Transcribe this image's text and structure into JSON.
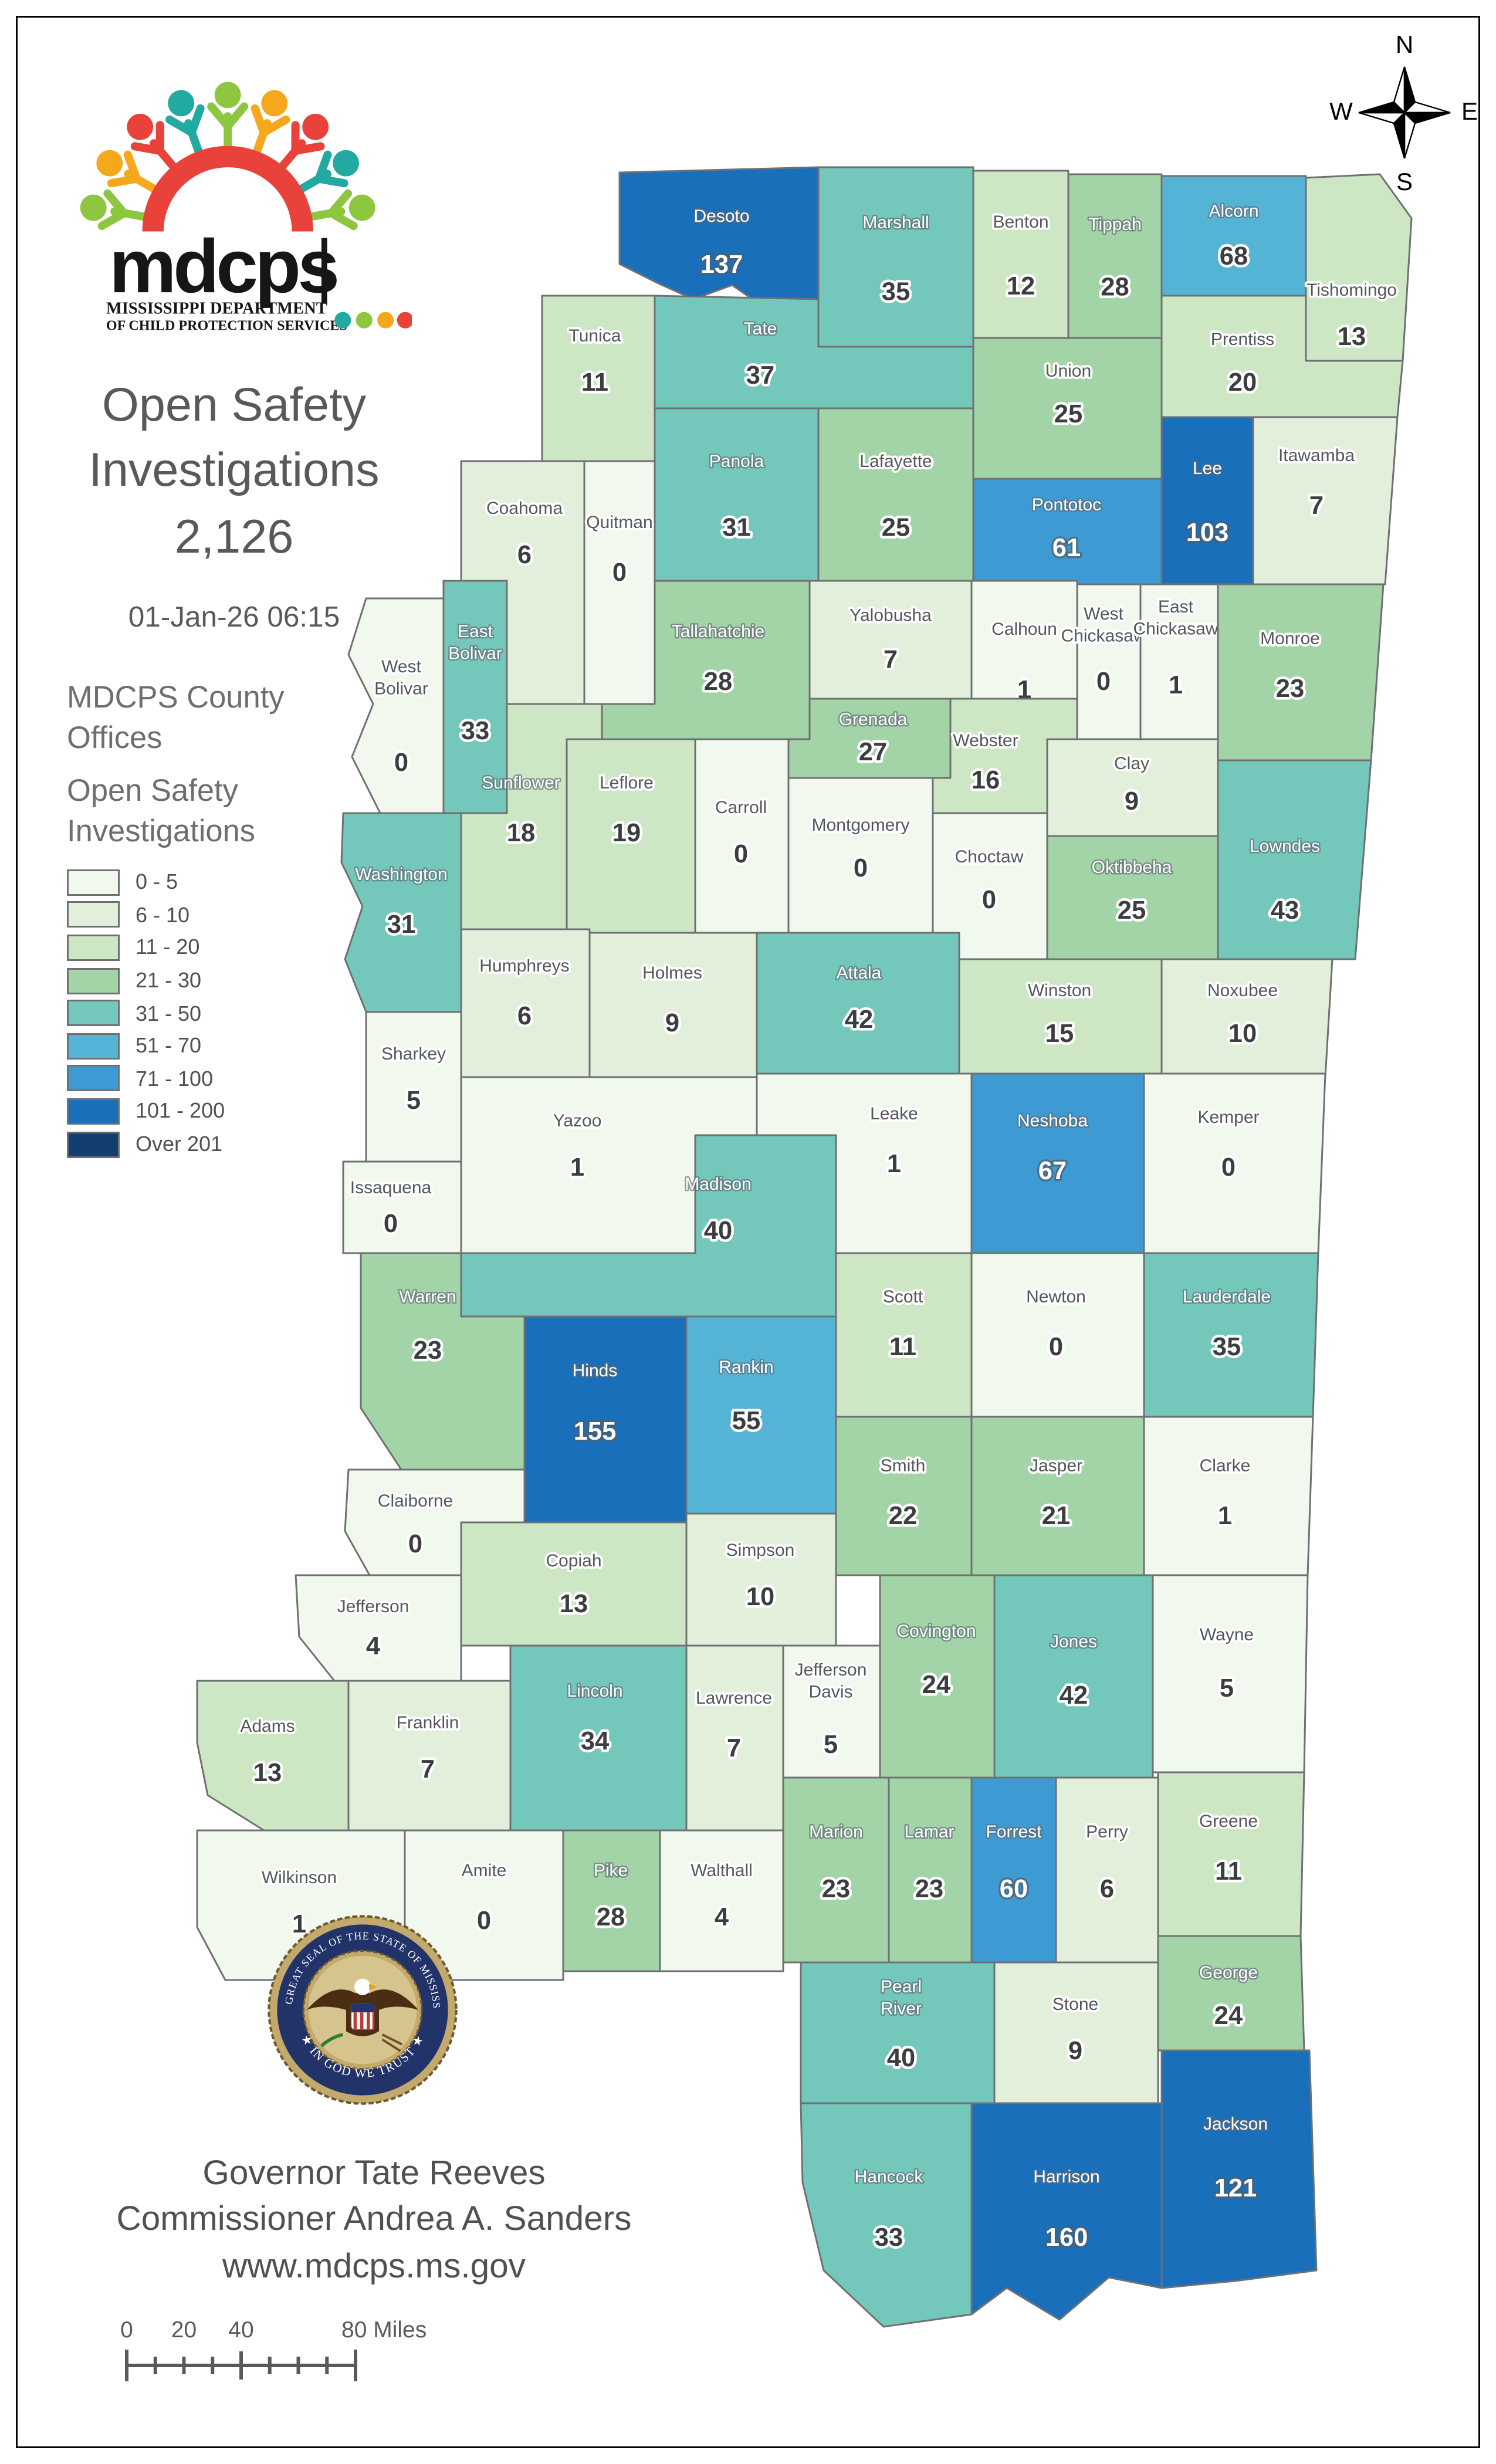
{
  "header": {
    "logo": {
      "acronym": "mdcps",
      "dept_line1": "MISSISSIPPI DEPARTMENT",
      "dept_line2": "OF CHILD PROTECTION SERVICES"
    },
    "title_lines": [
      "Open Safety",
      "Investigations",
      "2,126"
    ],
    "timestamp": "01-Jan-26 06:15"
  },
  "legend": {
    "offices_title_lines": [
      "MDCPS County",
      "Offices"
    ],
    "title_lines": [
      "Open Safety",
      "Investigations"
    ],
    "classes": [
      {
        "label": "0 - 5",
        "color": "#f1f8ed"
      },
      {
        "label": "6 - 10",
        "color": "#e2f0db"
      },
      {
        "label": "11 - 20",
        "color": "#cde7c5"
      },
      {
        "label": "21 - 30",
        "color": "#a3d4a7"
      },
      {
        "label": "31 - 50",
        "color": "#74c7bb"
      },
      {
        "label": "51 - 70",
        "color": "#55b4d5"
      },
      {
        "label": "71 - 100",
        "color": "#3e9ad2"
      },
      {
        "label": "101 - 200",
        "color": "#1a6fba"
      },
      {
        "label": "Over 201",
        "color": "#133f70"
      }
    ]
  },
  "compass": {
    "n": "N",
    "e": "E",
    "s": "S",
    "w": "W"
  },
  "map": {
    "counties": [
      {
        "name_lines": [
          "Desoto"
        ],
        "value": 137,
        "bucket": 8,
        "name_style": "light",
        "value_style": "light"
      },
      {
        "name_lines": [
          "Marshall"
        ],
        "value": 35,
        "bucket": 5,
        "name_style": "light",
        "value_style": "dark"
      },
      {
        "name_lines": [
          "Benton"
        ],
        "value": 12,
        "bucket": 3,
        "name_style": "dark",
        "value_style": "dark"
      },
      {
        "name_lines": [
          "Tippah"
        ],
        "value": 28,
        "bucket": 4,
        "name_style": "light",
        "value_style": "dark"
      },
      {
        "name_lines": [
          "Alcorn"
        ],
        "value": 68,
        "bucket": 6,
        "name_style": "light",
        "value_style": "dark"
      },
      {
        "name_lines": [
          "Tishomingo"
        ],
        "value": 13,
        "bucket": 3,
        "name_style": "dark",
        "value_style": "dark"
      },
      {
        "name_lines": [
          "Tunica"
        ],
        "value": 11,
        "bucket": 3,
        "name_style": "dark",
        "value_style": "dark"
      },
      {
        "name_lines": [
          "Tate"
        ],
        "value": 37,
        "bucket": 5,
        "name_style": "light",
        "value_style": "dark"
      },
      {
        "name_lines": [
          "Prentiss"
        ],
        "value": 20,
        "bucket": 3,
        "name_style": "dark",
        "value_style": "dark"
      },
      {
        "name_lines": [
          "Union"
        ],
        "value": 25,
        "bucket": 4,
        "name_style": "dark",
        "value_style": "dark"
      },
      {
        "name_lines": [
          "Lee"
        ],
        "value": 103,
        "bucket": 8,
        "name_style": "light",
        "value_style": "light"
      },
      {
        "name_lines": [
          "Itawamba"
        ],
        "value": 7,
        "bucket": 2,
        "name_style": "dark",
        "value_style": "dark"
      },
      {
        "name_lines": [
          "Pontotoc"
        ],
        "value": 61,
        "bucket": 7,
        "name_style": "light",
        "value_style": "light"
      },
      {
        "name_lines": [
          "Lafayette"
        ],
        "value": 25,
        "bucket": 4,
        "name_style": "dark",
        "value_style": "dark"
      },
      {
        "name_lines": [
          "Panola"
        ],
        "value": 31,
        "bucket": 5,
        "name_style": "light",
        "value_style": "dark"
      },
      {
        "name_lines": [
          "Coahoma"
        ],
        "value": 6,
        "bucket": 2,
        "name_style": "dark",
        "value_style": "dark"
      },
      {
        "name_lines": [
          "Quitman"
        ],
        "value": 0,
        "bucket": 1,
        "name_style": "dark",
        "value_style": "dark"
      },
      {
        "name_lines": [
          "Tallahatchie"
        ],
        "value": 28,
        "bucket": 4,
        "name_style": "light",
        "value_style": "dark"
      },
      {
        "name_lines": [
          "Yalobusha"
        ],
        "value": 7,
        "bucket": 2,
        "name_style": "dark",
        "value_style": "dark"
      },
      {
        "name_lines": [
          "Calhoun"
        ],
        "value": 1,
        "bucket": 1,
        "name_style": "dark",
        "value_style": "dark"
      },
      {
        "name_lines": [
          "West",
          "Chickasaw"
        ],
        "value": 0,
        "bucket": 1,
        "name_style": "dark",
        "value_style": "dark"
      },
      {
        "name_lines": [
          "East",
          "Chickasaw"
        ],
        "value": 1,
        "bucket": 1,
        "name_style": "dark",
        "value_style": "dark"
      },
      {
        "name_lines": [
          "Monroe"
        ],
        "value": 23,
        "bucket": 4,
        "name_style": "dark",
        "value_style": "dark"
      },
      {
        "name_lines": [
          "East",
          "Bolivar"
        ],
        "value": 33,
        "bucket": 5,
        "name_style": "light",
        "value_style": "dark"
      },
      {
        "name_lines": [
          "West",
          "Bolivar"
        ],
        "value": 0,
        "bucket": 1,
        "name_style": "dark",
        "value_style": "dark"
      },
      {
        "name_lines": [
          "Grenada"
        ],
        "value": 27,
        "bucket": 4,
        "name_style": "light",
        "value_style": "dark"
      },
      {
        "name_lines": [
          "Webster"
        ],
        "value": 16,
        "bucket": 3,
        "name_style": "dark",
        "value_style": "dark"
      },
      {
        "name_lines": [
          "Clay"
        ],
        "value": 9,
        "bucket": 2,
        "name_style": "dark",
        "value_style": "dark"
      },
      {
        "name_lines": [
          "Sunflower"
        ],
        "value": 18,
        "bucket": 3,
        "name_style": "light",
        "value_style": "dark"
      },
      {
        "name_lines": [
          "Leflore"
        ],
        "value": 19,
        "bucket": 3,
        "name_style": "dark",
        "value_style": "dark"
      },
      {
        "name_lines": [
          "Carroll"
        ],
        "value": 0,
        "bucket": 1,
        "name_style": "dark",
        "value_style": "dark"
      },
      {
        "name_lines": [
          "Montgomery"
        ],
        "value": 0,
        "bucket": 1,
        "name_style": "dark",
        "value_style": "dark"
      },
      {
        "name_lines": [
          "Choctaw"
        ],
        "value": 0,
        "bucket": 1,
        "name_style": "dark",
        "value_style": "dark"
      },
      {
        "name_lines": [
          "Oktibbeha"
        ],
        "value": 25,
        "bucket": 4,
        "name_style": "light",
        "value_style": "dark"
      },
      {
        "name_lines": [
          "Lowndes"
        ],
        "value": 43,
        "bucket": 5,
        "name_style": "light",
        "value_style": "dark"
      },
      {
        "name_lines": [
          "Washington"
        ],
        "value": 31,
        "bucket": 5,
        "name_style": "light",
        "value_style": "dark"
      },
      {
        "name_lines": [
          "Humphreys"
        ],
        "value": 6,
        "bucket": 2,
        "name_style": "dark",
        "value_style": "dark"
      },
      {
        "name_lines": [
          "Holmes"
        ],
        "value": 9,
        "bucket": 2,
        "name_style": "dark",
        "value_style": "dark"
      },
      {
        "name_lines": [
          "Attala"
        ],
        "value": 42,
        "bucket": 5,
        "name_style": "light",
        "value_style": "dark"
      },
      {
        "name_lines": [
          "Winston"
        ],
        "value": 15,
        "bucket": 3,
        "name_style": "dark",
        "value_style": "dark"
      },
      {
        "name_lines": [
          "Noxubee"
        ],
        "value": 10,
        "bucket": 2,
        "name_style": "dark",
        "value_style": "dark"
      },
      {
        "name_lines": [
          "Sharkey"
        ],
        "value": 5,
        "bucket": 1,
        "name_style": "dark",
        "value_style": "dark"
      },
      {
        "name_lines": [
          "Yazoo"
        ],
        "value": 1,
        "bucket": 1,
        "name_style": "dark",
        "value_style": "dark"
      },
      {
        "name_lines": [
          "Leake"
        ],
        "value": 1,
        "bucket": 1,
        "name_style": "dark",
        "value_style": "dark"
      },
      {
        "name_lines": [
          "Neshoba"
        ],
        "value": 67,
        "bucket": 7,
        "name_style": "light",
        "value_style": "light"
      },
      {
        "name_lines": [
          "Kemper"
        ],
        "value": 0,
        "bucket": 1,
        "name_style": "dark",
        "value_style": "dark"
      },
      {
        "name_lines": [
          "Issaquena"
        ],
        "value": 0,
        "bucket": 1,
        "name_style": "dark",
        "value_style": "dark"
      },
      {
        "name_lines": [
          "Madison"
        ],
        "value": 40,
        "bucket": 5,
        "name_style": "light",
        "value_style": "dark"
      },
      {
        "name_lines": [
          "Scott"
        ],
        "value": 11,
        "bucket": 3,
        "name_style": "dark",
        "value_style": "dark"
      },
      {
        "name_lines": [
          "Newton"
        ],
        "value": 0,
        "bucket": 1,
        "name_style": "dark",
        "value_style": "dark"
      },
      {
        "name_lines": [
          "Lauderdale"
        ],
        "value": 35,
        "bucket": 5,
        "name_style": "light",
        "value_style": "dark"
      },
      {
        "name_lines": [
          "Warren"
        ],
        "value": 23,
        "bucket": 4,
        "name_style": "light",
        "value_style": "dark"
      },
      {
        "name_lines": [
          "Hinds"
        ],
        "value": 155,
        "bucket": 8,
        "name_style": "light",
        "value_style": "light"
      },
      {
        "name_lines": [
          "Rankin"
        ],
        "value": 55,
        "bucket": 6,
        "name_style": "light",
        "value_style": "dark"
      },
      {
        "name_lines": [
          "Smith"
        ],
        "value": 22,
        "bucket": 4,
        "name_style": "dark",
        "value_style": "dark"
      },
      {
        "name_lines": [
          "Jasper"
        ],
        "value": 21,
        "bucket": 4,
        "name_style": "dark",
        "value_style": "dark"
      },
      {
        "name_lines": [
          "Clarke"
        ],
        "value": 1,
        "bucket": 1,
        "name_style": "dark",
        "value_style": "dark"
      },
      {
        "name_lines": [
          "Claiborne"
        ],
        "value": 0,
        "bucket": 1,
        "name_style": "dark",
        "value_style": "dark"
      },
      {
        "name_lines": [
          "Copiah"
        ],
        "value": 13,
        "bucket": 3,
        "name_style": "dark",
        "value_style": "dark"
      },
      {
        "name_lines": [
          "Simpson"
        ],
        "value": 10,
        "bucket": 2,
        "name_style": "dark",
        "value_style": "dark"
      },
      {
        "name_lines": [
          "Jefferson"
        ],
        "value": 4,
        "bucket": 1,
        "name_style": "dark",
        "value_style": "dark"
      },
      {
        "name_lines": [
          "Adams"
        ],
        "value": 13,
        "bucket": 3,
        "name_style": "dark",
        "value_style": "dark"
      },
      {
        "name_lines": [
          "Franklin"
        ],
        "value": 7,
        "bucket": 2,
        "name_style": "dark",
        "value_style": "dark"
      },
      {
        "name_lines": [
          "Lincoln"
        ],
        "value": 34,
        "bucket": 5,
        "name_style": "light",
        "value_style": "dark"
      },
      {
        "name_lines": [
          "Lawrence"
        ],
        "value": 7,
        "bucket": 2,
        "name_style": "dark",
        "value_style": "dark"
      },
      {
        "name_lines": [
          "Jefferson",
          "Davis"
        ],
        "value": 5,
        "bucket": 1,
        "name_style": "dark",
        "value_style": "dark"
      },
      {
        "name_lines": [
          "Covington"
        ],
        "value": 24,
        "bucket": 4,
        "name_style": "light",
        "value_style": "dark"
      },
      {
        "name_lines": [
          "Jones"
        ],
        "value": 42,
        "bucket": 5,
        "name_style": "light",
        "value_style": "dark"
      },
      {
        "name_lines": [
          "Wayne"
        ],
        "value": 5,
        "bucket": 1,
        "name_style": "dark",
        "value_style": "dark"
      },
      {
        "name_lines": [
          "Wilkinson"
        ],
        "value": 1,
        "bucket": 1,
        "name_style": "dark",
        "value_style": "dark"
      },
      {
        "name_lines": [
          "Amite"
        ],
        "value": 0,
        "bucket": 1,
        "name_style": "dark",
        "value_style": "dark"
      },
      {
        "name_lines": [
          "Pike"
        ],
        "value": 28,
        "bucket": 4,
        "name_style": "light",
        "value_style": "dark"
      },
      {
        "name_lines": [
          "Walthall"
        ],
        "value": 4,
        "bucket": 1,
        "name_style": "dark",
        "value_style": "dark"
      },
      {
        "name_lines": [
          "Marion"
        ],
        "value": 23,
        "bucket": 4,
        "name_style": "light",
        "value_style": "dark"
      },
      {
        "name_lines": [
          "Lamar"
        ],
        "value": 23,
        "bucket": 4,
        "name_style": "light",
        "value_style": "dark"
      },
      {
        "name_lines": [
          "Forrest"
        ],
        "value": 60,
        "bucket": 7,
        "name_style": "light",
        "value_style": "light"
      },
      {
        "name_lines": [
          "Perry"
        ],
        "value": 6,
        "bucket": 2,
        "name_style": "dark",
        "value_style": "dark"
      },
      {
        "name_lines": [
          "Greene"
        ],
        "value": 11,
        "bucket": 3,
        "name_style": "dark",
        "value_style": "dark"
      },
      {
        "name_lines": [
          "Pearl",
          "River"
        ],
        "value": 40,
        "bucket": 5,
        "name_style": "light",
        "value_style": "dark"
      },
      {
        "name_lines": [
          "Stone"
        ],
        "value": 9,
        "bucket": 2,
        "name_style": "dark",
        "value_style": "dark"
      },
      {
        "name_lines": [
          "George"
        ],
        "value": 24,
        "bucket": 4,
        "name_style": "light",
        "value_style": "dark"
      },
      {
        "name_lines": [
          "Hancock"
        ],
        "value": 33,
        "bucket": 5,
        "name_style": "light",
        "value_style": "dark"
      },
      {
        "name_lines": [
          "Harrison"
        ],
        "value": 160,
        "bucket": 8,
        "name_style": "light",
        "value_style": "light"
      },
      {
        "name_lines": [
          "Jackson"
        ],
        "value": 121,
        "bucket": 8,
        "name_style": "light",
        "value_style": "light"
      }
    ]
  },
  "footer": {
    "seal": {
      "arc_text": "THE GREAT SEAL OF THE STATE OF MISSISSIPPI",
      "motto": "★ IN GOD WE TRUST ★"
    },
    "lines": [
      "Governor Tate Reeves",
      "Commissioner Andrea A. Sanders",
      "www.mdcps.ms.gov"
    ]
  },
  "scalebar": {
    "labels": [
      "0",
      "20",
      "40",
      "80 Miles"
    ]
  }
}
